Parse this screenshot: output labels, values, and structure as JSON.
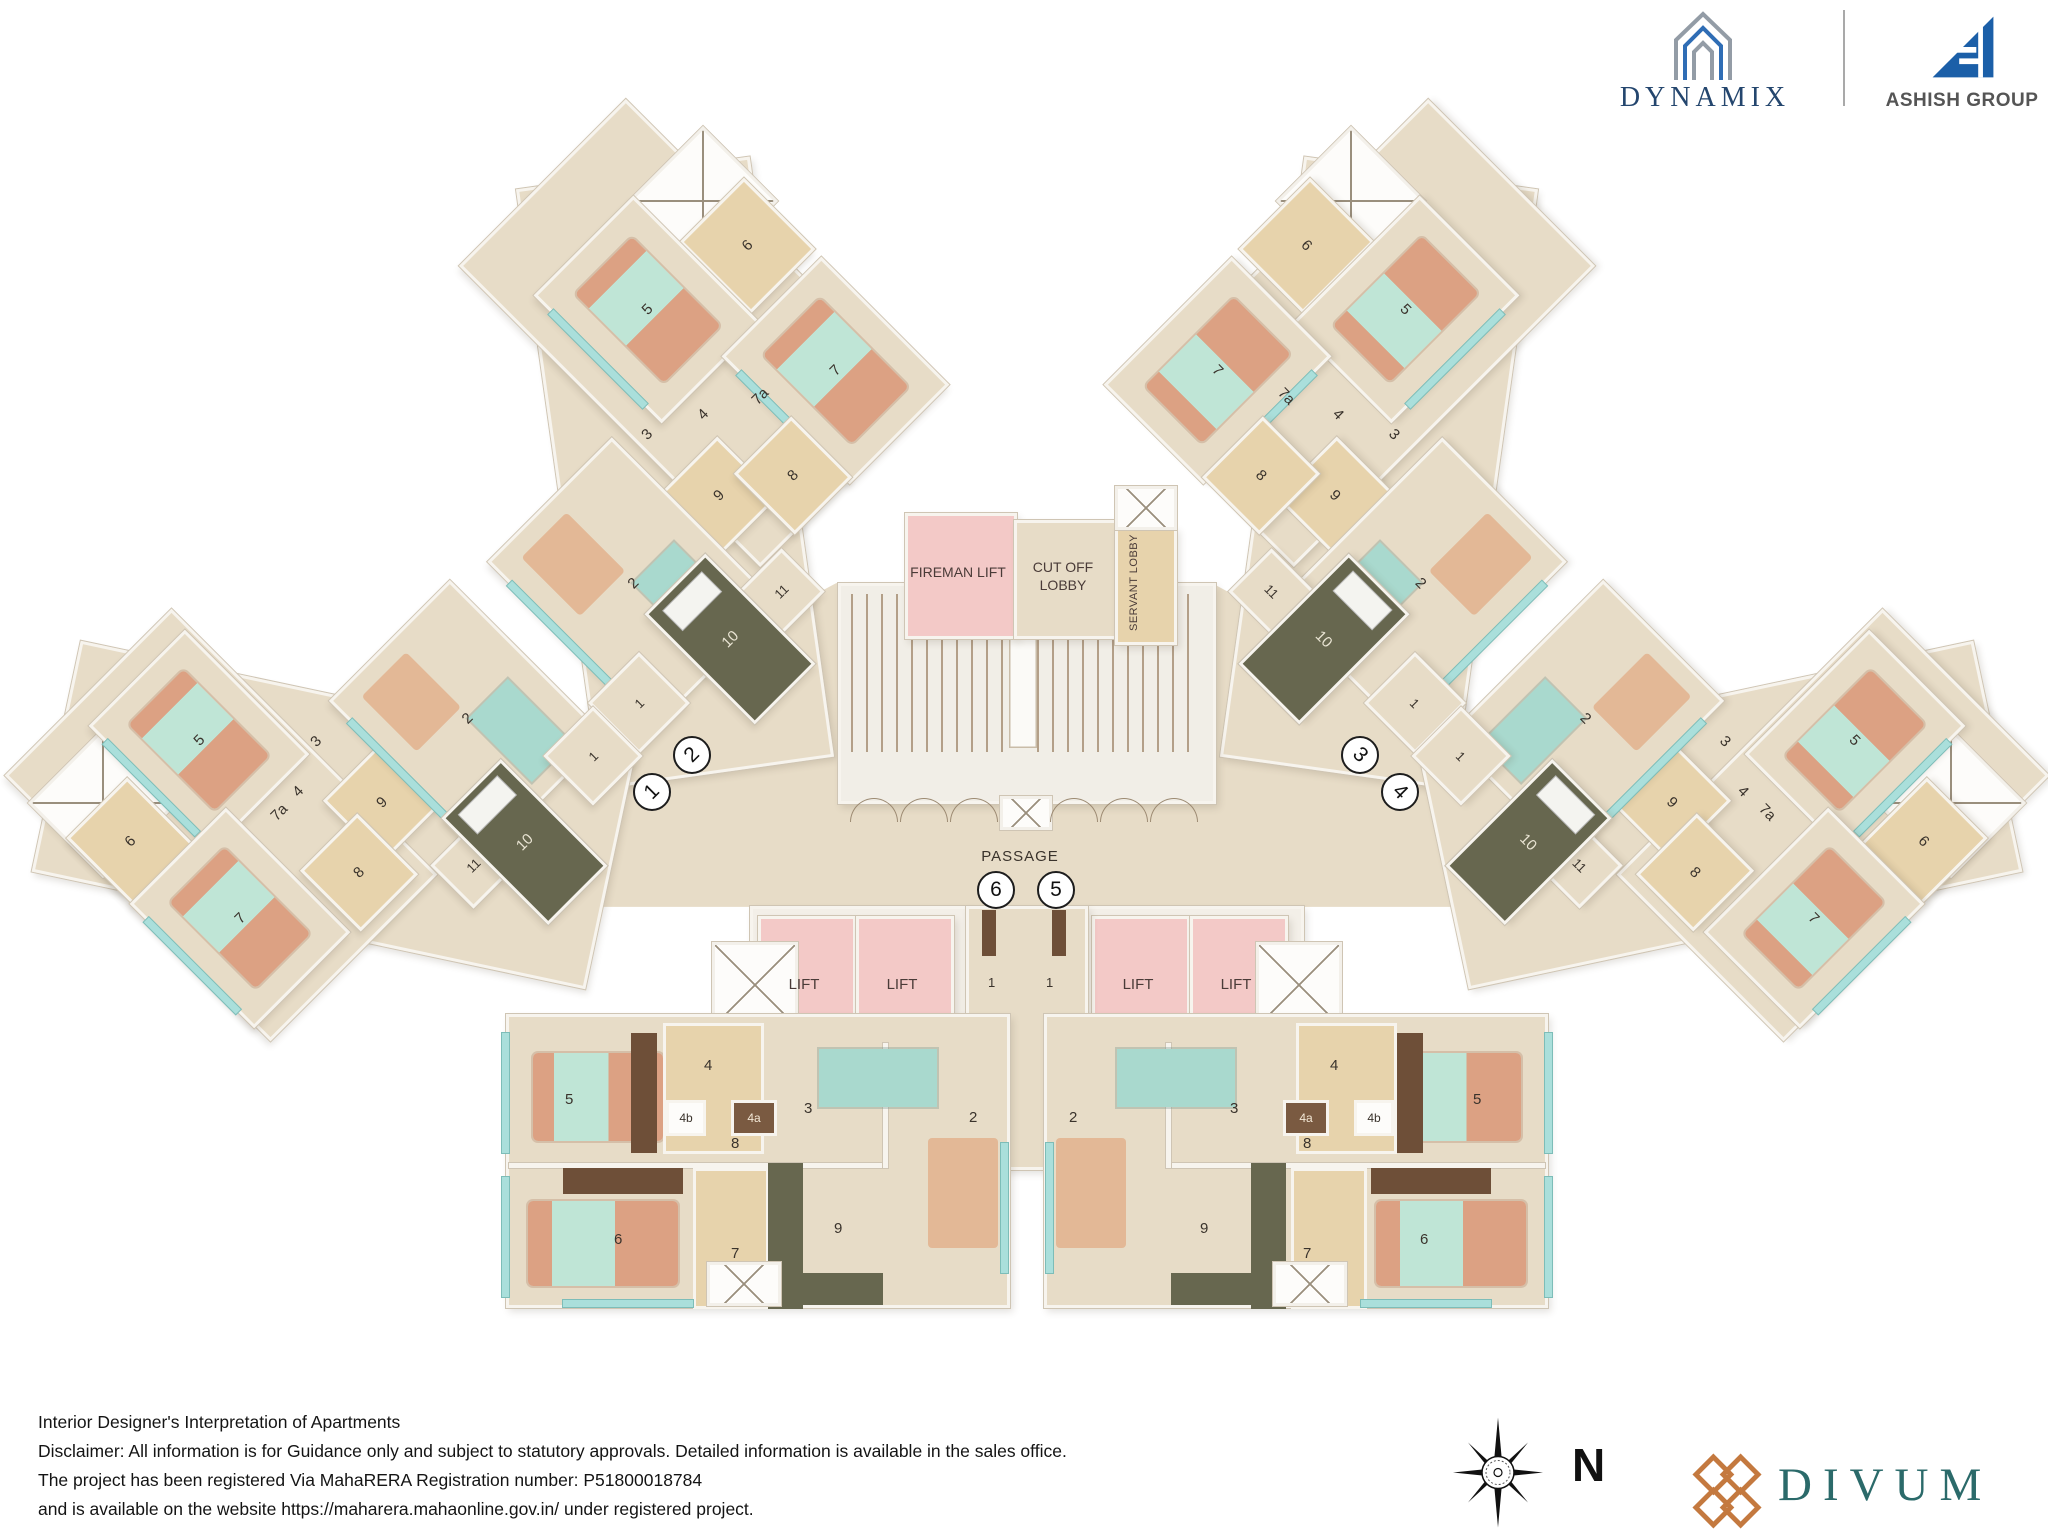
{
  "branding": {
    "dynamix": "DYNAMIX",
    "ashish_group": "ASHISH GROUP",
    "divum": "DIVUM"
  },
  "compass": {
    "north_label": "N"
  },
  "core": {
    "fireman_lift": "FIREMAN LIFT",
    "cut_off_lobby": "CUT OFF LOBBY",
    "servant_lobby": "SERVANT LOBBY",
    "passage": "PASSAGE",
    "lift_label": "LIFT",
    "lift_lobby_room": "1"
  },
  "unit_markers": [
    "1",
    "2",
    "3",
    "4",
    "5",
    "6"
  ],
  "wing_rooms": [
    "6",
    "5",
    "7",
    "7a",
    "4",
    "3",
    "9",
    "8",
    "2",
    "11",
    "10",
    "1"
  ],
  "apt_rooms": {
    "r5": "5",
    "r4": "4",
    "r4b": "4b",
    "r4a": "4a",
    "r8": "8",
    "r3": "3",
    "r2": "2",
    "r6": "6",
    "r7": "7",
    "r9": "9"
  },
  "footer": {
    "lines": [
      "Interior Designer's Interpretation of Apartments",
      "Disclaimer: All information is for Guidance only and subject to statutory approvals. Detailed information is available in the sales office.",
      "The project has been registered Via MahaRERA Registration number:  P51800018784",
      "and is available on the website https://maharera.mahaonline.gov.in/ under registered project."
    ]
  },
  "palette": {
    "floor_beige": "#e7dcc7",
    "toilet_tan": "#e7d3ac",
    "lift_pink": "#f3c9c7",
    "kitchen_olive": "#67674f",
    "window_teal": "#aadfdb",
    "wall_white": "#f7f4ee",
    "wood_brown": "#6e4f38",
    "dynamix_blue": "#24466e",
    "ashish_blue": "#1b5fa8",
    "divum_teal": "#2b6a6a",
    "divum_copper": "#c4793f"
  }
}
